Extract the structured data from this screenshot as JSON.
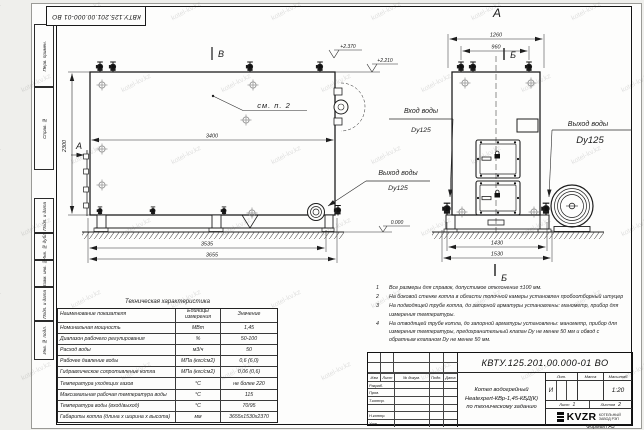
{
  "watermark": {
    "text": "kotel-kv.kz"
  },
  "stamp_top": "КВТУ.125.201.00.000-01 ВО",
  "margin_labels": [
    "Перв. примен.",
    "Справ. №",
    "Подп. и дата",
    "Инв. № дубл.",
    "Взам. инв. №",
    "Подп. и дата",
    "Инв. № подл."
  ],
  "views": {
    "main": {
      "marker_top": "В",
      "marker_left": "А",
      "see_note": "см. п. 2",
      "dim_length": "3400",
      "dim_height": "2300",
      "dim_base1": "3535",
      "dim_base2": "3655",
      "elev1": "+2.370",
      "elev2": "+2.210",
      "elev_zero": "0.000",
      "outlet_label": "Выход воды",
      "outlet_dn": "Dy125"
    },
    "front": {
      "title": "А",
      "section": "Б",
      "dim_top1": "1260",
      "dim_top2": "960",
      "dim_base1": "1430",
      "dim_base2": "1530",
      "inlet_label": "Вход воды",
      "inlet_dn": "Dy125",
      "outlet_label": "Выход воды",
      "outlet_dn": "Dy125"
    }
  },
  "tech_table": {
    "title": "Техническая характеристика",
    "headers": [
      "Наименование показателя",
      "Единицы измерения",
      "Значение"
    ],
    "rows": [
      {
        "name": "Номинальная мощность",
        "unit": "МВт",
        "value": "1,45"
      },
      {
        "name": "Диапазон рабочего регулирования",
        "unit": "%",
        "value": "50-100"
      },
      {
        "name": "Расход воды",
        "unit": "м3/ч",
        "value": "50"
      },
      {
        "name": "Рабочее давление воды",
        "unit": "МПа (кгс/см2)",
        "value": "0,6 (6,0)"
      },
      {
        "name": "Гидравлическое сопротивление котла",
        "unit": "МПа (кгс/см2)",
        "value": "0,06 (0,6)"
      },
      {
        "name": "Температура уходящих газов",
        "unit": "°С",
        "value": "не более 220"
      },
      {
        "name": "Максимальная рабочая температура воды",
        "unit": "°С",
        "value": "115"
      },
      {
        "name": "Температура воды (вход/выход)",
        "unit": "°С",
        "value": "70/95"
      },
      {
        "name": "Габариты котла (длина х ширина х высота)",
        "unit": "мм",
        "value": "3655х1530х2370"
      }
    ]
  },
  "notes": [
    {
      "num": "1",
      "text": "Все размеры для справок, допустимое отклонение ±100 мм."
    },
    {
      "num": "2",
      "text": "На боковой стенке котла в области топочной камеры установлен пробоотборный штуцер"
    },
    {
      "num": "3",
      "text": "На подводящей трубе котла, до запорной арматуры установлены: манометр, прибор для измерения температуры."
    },
    {
      "num": "4",
      "text": "На отводящей трубе котла, до запорной арматуры установлены: манометр, прибор для измерения температуры, предохранительный клапан Dу не менее 50 мм и обвод с обратным клапаном Dу не менее 50 мм."
    }
  ],
  "title_block": {
    "doc_number": "КВТУ.125.201.00.000-01  ВО",
    "rev_headers": [
      "Изм",
      "Лист",
      "№ докум.",
      "Подп.",
      "Дата"
    ],
    "roles": [
      "Разраб.",
      "Пров.",
      "Т.контр.",
      "",
      "Н.контр.",
      "Утв."
    ],
    "product_line1": "Котел водогрейный",
    "product_line2": "Heatexpert-КВр-1,45-КБД(К)",
    "product_line3": "по техническому заданию",
    "lit_header": "Лит.",
    "mass_header": "Масса",
    "scale_header": "Масштаб",
    "lit_value": "И",
    "scale_value": "1:20",
    "sheet_label": "Лист",
    "sheet_value": "1",
    "sheets_label": "Листов",
    "sheets_value": "2",
    "logo": "KVZR",
    "logo_sub1": "КОТЕЛЬНЫЙ",
    "logo_sub2": "ЗАВОД РЭП",
    "format": "Формат А3"
  }
}
